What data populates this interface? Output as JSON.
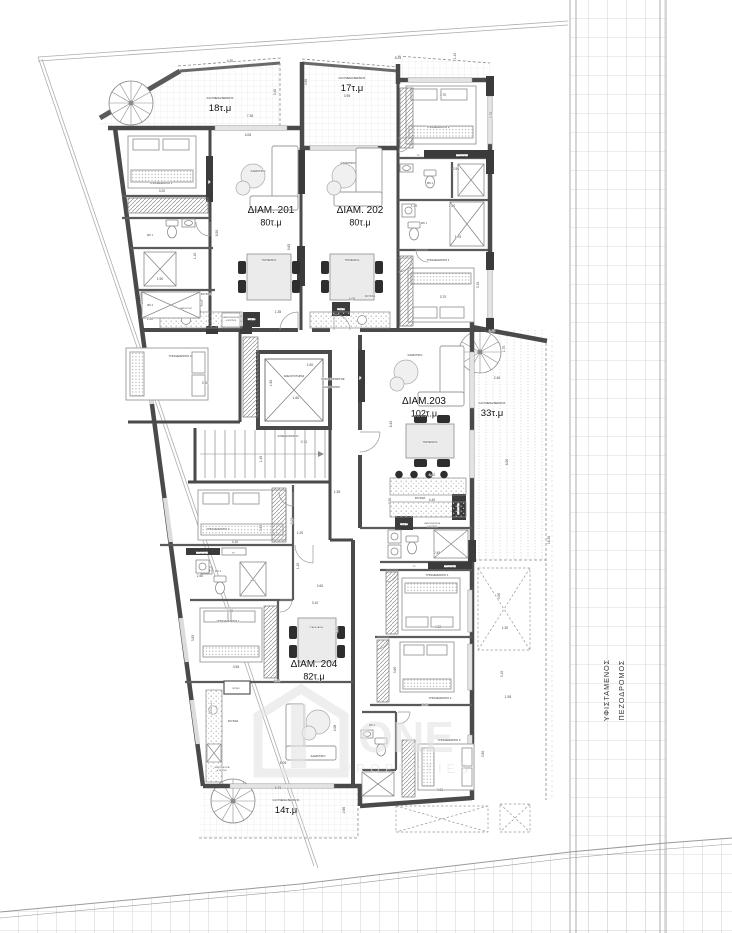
{
  "plan": {
    "colors": {
      "wall": "#4a4a4a",
      "dark_block": "#3b3b3b",
      "dimension_text": "#444444",
      "label_text": "#222222",
      "road_grid": "#b5b5b5",
      "watermark": "#e4e4e4"
    },
    "apartments": [
      {
        "name": "ΔΙΑΜ. 201",
        "area": "80τ.μ",
        "x": 271,
        "y": 213
      },
      {
        "name": "ΔΙΑΜ. 202",
        "area": "80τ.μ",
        "x": 360,
        "y": 213
      },
      {
        "name": "ΔΙΑΜ.203",
        "area": "102τ.μ",
        "x": 424,
        "y": 404
      },
      {
        "name": "ΔΙΑΜ. 204",
        "area": "82τ.μ",
        "x": 314,
        "y": 667
      }
    ],
    "verandas": [
      {
        "caption": "ΚΑΛΥΜΕΝΗ ΒΕΡΑΝΤΑ",
        "area": "18τ.μ",
        "x": 220,
        "y": 99
      },
      {
        "caption": "ΚΑΛΥΜΕΝΗ ΒΕΡΑΝΤΑ",
        "area": "17τ.μ",
        "x": 352,
        "y": 79
      },
      {
        "caption": "ΚΑΛΥΜΕΝΗ ΒΕΡΑΝΤΑ",
        "area": "33τ.μ",
        "x": 492,
        "y": 404
      },
      {
        "caption": "ΚΑΛΥΜΕΝΗ ΒΕΡΑΝΤΑ",
        "area": "14τ.μ",
        "x": 286,
        "y": 801
      }
    ],
    "road": {
      "line1": "ΥΦΙΣΤΑΜΕΝΟΣ",
      "line2": "ΠΕΖΟΔΡΟΜΟΣ"
    },
    "watermark": {
      "word": "ONE",
      "sub": "PROPERTIES"
    },
    "room_labels": [
      {
        "t": "ΥΠΝΟΔΩΜΑΤΙΟ 1",
        "x": 161,
        "y": 184
      },
      {
        "t": "ΥΠΝΟΔΩΜΑΤΙΟ 2",
        "x": 180,
        "y": 357
      },
      {
        "t": "ΚΑΘΙΣΤΙΚΟ",
        "x": 258,
        "y": 172
      },
      {
        "t": "ΤΡΑΠΕΖΑΡΙΑ",
        "x": 269,
        "y": 261,
        "s": 2.4
      },
      {
        "t": "ΚΟΥΖΙΝΑ",
        "x": 206,
        "y": 295,
        "s": 2.4
      },
      {
        "t": "ΝΕΡΟΧΥΤΗΣ",
        "x": 186,
        "y": 309,
        "s": 1.9
      },
      {
        "t": "ΗΛΕΚΤΡΙΚΗ ΕΣΤΙΑ",
        "x": 231,
        "y": 318,
        "s": 1.8
      },
      {
        "t": "& ΦΟΥΡΝΟΣ",
        "x": 231,
        "y": 321,
        "s": 1.8
      },
      {
        "t": "ΨΥΓΕΙΟ",
        "x": 251.5,
        "y": 320,
        "s": 2,
        "c": "#fff"
      },
      {
        "t": "WC 1",
        "x": 150,
        "y": 236,
        "s": 2.4
      },
      {
        "t": "WC 2",
        "x": 150,
        "y": 306,
        "s": 2.4
      },
      {
        "t": "TV",
        "x": 210,
        "y": 182,
        "s": 2.2,
        "r": 1,
        "c": "#fff"
      },
      {
        "t": "ΚΑΘΙΣΤΙΚΟ",
        "x": 348,
        "y": 164
      },
      {
        "t": "ΤΡΑΠΕΖΑΡΙΑ",
        "x": 352,
        "y": 261,
        "s": 2.4
      },
      {
        "t": "ΥΠΝΟΔΩΜΑΤΙΟ 2",
        "x": 438,
        "y": 128
      },
      {
        "t": "ΥΠΝΟΔΩΜΑΤΙΟ 1",
        "x": 438,
        "y": 261
      },
      {
        "t": "WC 2",
        "x": 430,
        "y": 184,
        "s": 2.4
      },
      {
        "t": "WC 1",
        "x": 424,
        "y": 224,
        "s": 2.4
      },
      {
        "t": "TV",
        "x": 418,
        "y": 156,
        "s": 2.1
      },
      {
        "t": "ΚΑΘΡΕΦΤΗΣ",
        "x": 462,
        "y": 156,
        "s": 1.9,
        "c": "#fff"
      },
      {
        "t": "ΚΟΥΖΙΝΑ",
        "x": 370,
        "y": 297,
        "s": 2.4
      },
      {
        "t": "ΨΥΓΕΙΟ",
        "x": 341,
        "y": 310,
        "s": 2,
        "c": "#fff"
      },
      {
        "t": "ΑΝΕΛΚΥΣΤΗΡΑΣ",
        "x": 294,
        "y": 377,
        "s": 2.6
      },
      {
        "t": "ΚΟΙΝΟΧΡΗΣΤΟΣ",
        "x": 333,
        "y": 380,
        "s": 3
      },
      {
        "t": "ΔΙΑΔΡΟΜΟΣ",
        "x": 331,
        "y": 388,
        "s": 3
      },
      {
        "t": "ΚΛΙΜΑΚΟΣΤΑΣΙΟ",
        "x": 288,
        "y": 437,
        "s": 2.6
      },
      {
        "t": "ΚΑΘΙΣΤΙΚΟ",
        "x": 415,
        "y": 356
      },
      {
        "t": "ΤΡΑΠΕΖΑΡΙΑ",
        "x": 430,
        "y": 443,
        "s": 2.4
      },
      {
        "t": "ΚΟΥΖΙΝΑ",
        "x": 420,
        "y": 499,
        "s": 2.4
      },
      {
        "t": "ΝΕΡΟΧΥΤΗΣ",
        "x": 459,
        "y": 509,
        "s": 1.8,
        "r": 1,
        "c": "#fff"
      },
      {
        "t": "ΗΛΕΚΤΡΙΚΗ ΕΣΤΙΑ",
        "x": 432,
        "y": 524,
        "s": 1.8
      },
      {
        "t": "& ΦΟΥΡΝΟΣ",
        "x": 432,
        "y": 527,
        "s": 1.8
      },
      {
        "t": "ΨΥΓΕΙΟ",
        "x": 404,
        "y": 525,
        "s": 2,
        "c": "#fff"
      },
      {
        "t": "ΥΠΝΟΔΩΜΑΤΙΟ 1",
        "x": 437,
        "y": 576
      },
      {
        "t": "ΥΠΝΟΔΩΜΑΤΙΟ 2",
        "x": 440,
        "y": 699
      },
      {
        "t": "ΥΠΝΟΔΩΜΑΤΙΟ 3",
        "x": 449,
        "y": 741
      },
      {
        "t": "TV",
        "x": 414,
        "y": 567,
        "s": 2.1
      },
      {
        "t": "ΚΑΘΡΕΦΤΗΣ",
        "x": 450,
        "y": 567,
        "s": 1.9,
        "c": "#fff"
      },
      {
        "t": "WC 2",
        "x": 372,
        "y": 726,
        "s": 2.4
      },
      {
        "t": "ΥΠΝΟΔΩΜΑΤΙΟ 2",
        "x": 218,
        "y": 530
      },
      {
        "t": "ΥΠΝΟΔΩΜΑΤΙΟ 1",
        "x": 228,
        "y": 622
      },
      {
        "t": "ΚΑΘΙΣΤΙΚΟ",
        "x": 318,
        "y": 757
      },
      {
        "t": "ΤΡΑΠΕΖΑΡΙΑ",
        "x": 316,
        "y": 628,
        "s": 2.2
      },
      {
        "t": "ΚΟΥΖΙΝΑ",
        "x": 233,
        "y": 722,
        "s": 2.4
      },
      {
        "t": "ΝΕΡΟΧΥΤΗΣ",
        "x": 212,
        "y": 708,
        "s": 1.8,
        "r": 1
      },
      {
        "t": "ΗΛΕΚΤΡΙΚΗ ΕΣΤΙΑ",
        "x": 222,
        "y": 768,
        "s": 1.7
      },
      {
        "t": "& ΦΟΥΡΝΟΣ",
        "x": 222,
        "y": 771,
        "s": 1.7
      },
      {
        "t": "ΨΥΓΕΙΟ",
        "x": 236,
        "y": 689,
        "s": 2
      },
      {
        "t": "ΚΑΘΡΕΦΤΗΣ",
        "x": 202,
        "y": 553.5,
        "s": 1.9,
        "c": "#fff"
      },
      {
        "t": "TV",
        "x": 233,
        "y": 553.5,
        "s": 2.1
      },
      {
        "t": "WC 1",
        "x": 218,
        "y": 572,
        "s": 2.4
      },
      {
        "t": "ντουζ",
        "x": 253,
        "y": 581,
        "s": 2.1
      },
      {
        "t": "TV",
        "x": 361,
        "y": 378,
        "s": 2.1,
        "r": 1,
        "c": "#fff"
      }
    ],
    "dimensions": [
      {
        "t": "4.30",
        "x": 230,
        "y": 62
      },
      {
        "t": "7.35",
        "x": 250,
        "y": 117
      },
      {
        "t": "3.40",
        "x": 276,
        "y": 92,
        "r": 1
      },
      {
        "t": "8.25",
        "x": 398,
        "y": 59
      },
      {
        "t": "1.10",
        "x": 456,
        "y": 56,
        "r": 1
      },
      {
        "t": "3.95",
        "x": 347,
        "y": 97
      },
      {
        "t": "3.90",
        "x": 307,
        "y": 82,
        "r": 1
      },
      {
        "t": "3.70",
        "x": 443,
        "y": 96
      },
      {
        "t": "3.70",
        "x": 492,
        "y": 115,
        "r": 1
      },
      {
        "t": "2.50",
        "x": 456,
        "y": 170
      },
      {
        "t": "1.10",
        "x": 414,
        "y": 207
      },
      {
        "t": "2.50",
        "x": 452,
        "y": 207
      },
      {
        "t": "1.75",
        "x": 458,
        "y": 238
      },
      {
        "t": "3.70",
        "x": 443,
        "y": 298
      },
      {
        "t": "3.15",
        "x": 479,
        "y": 285,
        "r": 1
      },
      {
        "t": "4.06",
        "x": 248,
        "y": 136
      },
      {
        "t": "4.05",
        "x": 352,
        "y": 300
      },
      {
        "t": "8.50",
        "x": 218,
        "y": 233,
        "r": 1
      },
      {
        "t": "9.65",
        "x": 290,
        "y": 247,
        "r": 1
      },
      {
        "t": "3.20",
        "x": 162,
        "y": 192
      },
      {
        "t": "1.10",
        "x": 196,
        "y": 256,
        "r": 1
      },
      {
        "t": "1.90",
        "x": 160,
        "y": 280
      },
      {
        "t": "2.30",
        "x": 143,
        "y": 301,
        "r": 1
      },
      {
        "t": "1.20",
        "x": 150,
        "y": 320
      },
      {
        "t": "1.60",
        "x": 310,
        "y": 366
      },
      {
        "t": "1.50",
        "x": 272,
        "y": 383,
        "r": 1
      },
      {
        "t": "1.60",
        "x": 296,
        "y": 399
      },
      {
        "t": "0.70",
        "x": 304,
        "y": 443
      },
      {
        "t": "1.45",
        "x": 262,
        "y": 459,
        "r": 1
      },
      {
        "t": "1.35",
        "x": 337,
        "y": 493
      },
      {
        "t": "3.90",
        "x": 205,
        "y": 384
      },
      {
        "t": "1.35",
        "x": 278,
        "y": 313
      },
      {
        "t": "3.25",
        "x": 492,
        "y": 332
      },
      {
        "t": "1.75",
        "x": 505,
        "y": 349,
        "r": 1
      },
      {
        "t": "2.45",
        "x": 497,
        "y": 379
      },
      {
        "t": "8.90",
        "x": 508,
        "y": 462,
        "r": 1
      },
      {
        "t": "16.35",
        "x": 550,
        "y": 540,
        "r": 1
      },
      {
        "t": "8.45",
        "x": 392,
        "y": 424,
        "r": 1
      },
      {
        "t": "4.40",
        "x": 432,
        "y": 476
      },
      {
        "t": "3.20",
        "x": 391,
        "y": 501,
        "r": 1
      },
      {
        "t": "4.40",
        "x": 432,
        "y": 501
      },
      {
        "t": "2.45",
        "x": 437,
        "y": 554
      },
      {
        "t": "3.50",
        "x": 500,
        "y": 596,
        "r": 1
      },
      {
        "t": "1.30",
        "x": 505,
        "y": 629
      },
      {
        "t": "4.22",
        "x": 438,
        "y": 628
      },
      {
        "t": "3.60",
        "x": 396,
        "y": 670,
        "r": 1
      },
      {
        "t": "3.10",
        "x": 503,
        "y": 674,
        "r": 1
      },
      {
        "t": "3.60",
        "x": 425,
        "y": 706
      },
      {
        "t": "1.95",
        "x": 508,
        "y": 698
      },
      {
        "t": "3.50",
        "x": 484,
        "y": 754,
        "r": 1
      },
      {
        "t": "3.60",
        "x": 440,
        "y": 791
      },
      {
        "t": "3.10",
        "x": 315,
        "y": 604
      },
      {
        "t": "4.35",
        "x": 338,
        "y": 630,
        "r": 1
      },
      {
        "t": "3.85",
        "x": 194,
        "y": 638,
        "r": 1
      },
      {
        "t": "3.80",
        "x": 230,
        "y": 612
      },
      {
        "t": "3.55",
        "x": 236,
        "y": 668
      },
      {
        "t": "6.60",
        "x": 277,
        "y": 682
      },
      {
        "t": "4.06",
        "x": 336,
        "y": 728,
        "r": 1
      },
      {
        "t": "6.05",
        "x": 283,
        "y": 764
      },
      {
        "t": "6.35",
        "x": 278,
        "y": 789
      },
      {
        "t": "2.66",
        "x": 345,
        "y": 810,
        "r": 1
      },
      {
        "t": "2.60",
        "x": 320,
        "y": 587
      },
      {
        "t": "4.10",
        "x": 235,
        "y": 543
      },
      {
        "t": "1.20",
        "x": 300,
        "y": 534
      },
      {
        "t": "2.50",
        "x": 200,
        "y": 577
      },
      {
        "t": "1.10",
        "x": 299,
        "y": 566,
        "r": 1
      },
      {
        "t": "3.15",
        "x": 293,
        "y": 521,
        "r": 1
      },
      {
        "t": "3.90",
        "x": 262,
        "y": 528,
        "r": 1
      }
    ]
  }
}
